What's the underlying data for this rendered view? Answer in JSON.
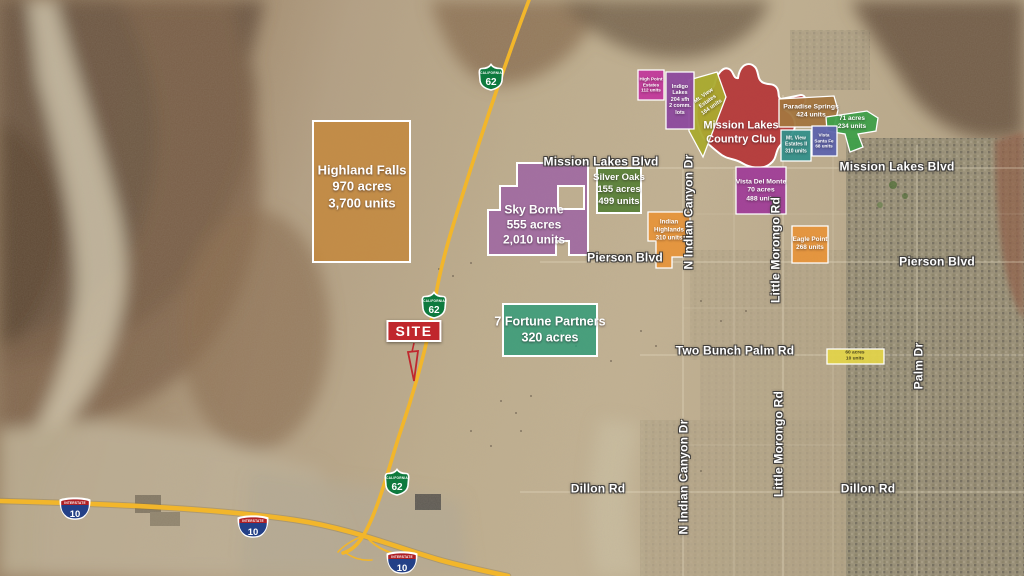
{
  "colors": {
    "highway": "#F2B62B",
    "site_red": "#C0272D",
    "label_halo": "#3C3C3C"
  },
  "parcels": [
    {
      "name": "highland-falls",
      "color": "#C4873B",
      "label_lines": [
        "Highland Falls",
        "970 acres",
        "3,700 units"
      ]
    },
    {
      "name": "sky-borne",
      "color": "#9C61A4",
      "label_lines": [
        "Sky Borne",
        "555 acres",
        "2,010 units"
      ]
    },
    {
      "name": "silver-oaks",
      "color": "#4C7A2D",
      "label_lines": [
        "Silver Oaks",
        "155 acres",
        "499 units"
      ]
    },
    {
      "name": "mission-lakes-country-club",
      "color": "#B3272D",
      "label_lines": [
        "Mission Lakes",
        "Country Club"
      ]
    },
    {
      "name": "mt-view-estates",
      "color": "#AAAA2F",
      "label_lines": [
        "Mt. View",
        "Estates",
        "164 units"
      ]
    },
    {
      "name": "high-point-estates",
      "color": "#C23A9C",
      "label_lines": [
        "High Point",
        "Estates",
        "112 units"
      ]
    },
    {
      "name": "indigo-lakes",
      "color": "#8D4A9E",
      "label_lines": [
        "Indigo",
        "Lakes",
        "204 sfh",
        "2 comm.",
        "lots"
      ]
    },
    {
      "name": "paradise-springs",
      "color": "#A3763F",
      "label_lines": [
        "Paradise Springs",
        "424 units"
      ]
    },
    {
      "name": "71-acres",
      "color": "#3FA04A",
      "label_lines": [
        "71 acres",
        "234 units"
      ]
    },
    {
      "name": "mt-view-estates-ii",
      "color": "#35908A",
      "label_lines": [
        "Mt. View",
        "Estates II",
        "310 units"
      ]
    },
    {
      "name": "vista-santa-fe",
      "color": "#5E64AD",
      "label_lines": [
        "Vista",
        "Santa Fe",
        "68 units"
      ]
    },
    {
      "name": "vista-del-monte",
      "color": "#A03F98",
      "label_lines": [
        "Vista Del Monte",
        "70 acres",
        "488 units"
      ]
    },
    {
      "name": "indian-highlands",
      "color": "#E6953C",
      "label_lines": [
        "Indian",
        "Highlands",
        "310 units"
      ]
    },
    {
      "name": "eagle-point",
      "color": "#E6953C",
      "label_lines": [
        "Eagle Point",
        "268 units"
      ]
    },
    {
      "name": "7-fortune-partners",
      "color": "#2E9B77",
      "label_lines": [
        "7 Fortune Partners",
        "320 acres"
      ]
    },
    {
      "name": "60-acres",
      "color": "#E2D34B",
      "label_lines": [
        "60 acres",
        "10 units"
      ]
    }
  ],
  "road_labels": [
    {
      "text": "Mission Lakes Blvd"
    },
    {
      "text": "Mission Lakes Blvd"
    },
    {
      "text": "Pierson Blvd"
    },
    {
      "text": "Pierson Blvd"
    },
    {
      "text": "Two Bunch Palm Rd"
    },
    {
      "text": "Dillon Rd"
    },
    {
      "text": "Dillon Rd"
    },
    {
      "text": "N Indian Canyon Dr"
    },
    {
      "text": "N Indian Canyon Dr"
    },
    {
      "text": "Little Morongo Rd"
    },
    {
      "text": "Little Morongo Rd"
    },
    {
      "text": "Palm Dr"
    }
  ],
  "shields": {
    "ca62": {
      "route": "62",
      "state": "CALIFORNIA"
    },
    "i10": {
      "route": "10",
      "band": "INTERSTATE"
    }
  },
  "site_marker": {
    "label": "SITE"
  }
}
